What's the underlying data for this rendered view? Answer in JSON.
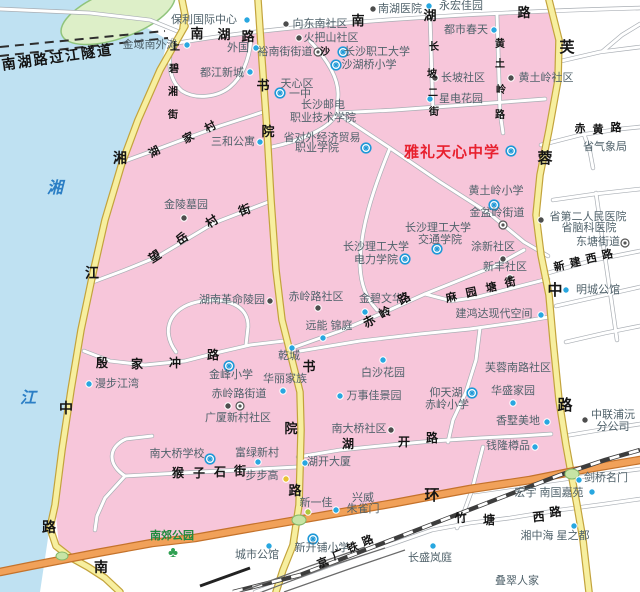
{
  "colors": {
    "water": "#bfe1f2",
    "urban_pink": "#f7c6da",
    "island_fill": "#ddefc8",
    "island_stroke": "#90c47c",
    "yellow_road": "#f7ef9f",
    "orange_ring": "#f1a159",
    "white_road": "#ffffff",
    "dot_blue": "#28a7e0",
    "dot_dark": "#4d4d4d",
    "dot_yellow": "#e8c133",
    "dot_ygreen": "#afc83c",
    "school_blue": "#1e98d7",
    "subdistrict_gray": "#555555",
    "park_green": "#2fa052",
    "poi_text": "#50626b",
    "highlight_red": "#e8202e",
    "river_text": "#2b7ec5",
    "green_blob": "#c7e4a5"
  },
  "icons": {
    "park_glyph": "♣"
  },
  "poi_labels": [
    {
      "t": "保利国际中心",
      "x": 204,
      "y": 23
    },
    {
      "t": "南湖医院",
      "x": 400,
      "y": 12
    },
    {
      "t": "永宏佳园",
      "x": 461,
      "y": 9
    },
    {
      "t": "向东南社区",
      "x": 320,
      "y": 27
    },
    {
      "t": "金域南外滩",
      "x": 150,
      "y": 48
    },
    {
      "t": "外国",
      "x": 238,
      "y": 51
    },
    {
      "t": "火把山社区",
      "x": 331,
      "y": 41
    },
    {
      "t": "裕南街街道",
      "x": 285,
      "y": 55
    },
    {
      "t": "都江新城",
      "x": 222,
      "y": 76
    },
    {
      "t": "都市春天",
      "x": 466,
      "y": 33
    },
    {
      "t": "长坡社区",
      "x": 463,
      "y": 81
    },
    {
      "t": "星电花园",
      "x": 461,
      "y": 102
    },
    {
      "t": "黄土岭社区",
      "x": 546,
      "y": 81
    },
    {
      "t": "三和公寓",
      "x": 233,
      "y": 145
    },
    {
      "t": "天心区",
      "x": 297,
      "y": 87
    },
    {
      "t": "一中",
      "x": 300,
      "y": 97
    },
    {
      "t": "长沙邮电",
      "x": 323,
      "y": 108
    },
    {
      "t": "职业技术学院",
      "x": 323,
      "y": 121
    },
    {
      "t": "省对外经济贸易",
      "x": 322,
      "y": 141
    },
    {
      "t": "职业学院",
      "x": 317,
      "y": 151
    },
    {
      "t": "沙湖桥小学",
      "x": 369,
      "y": 68
    },
    {
      "t": "长沙职工大学",
      "x": 377,
      "y": 55
    },
    {
      "t": "雅礼天心中学",
      "x": 452,
      "y": 157,
      "cls": "red"
    },
    {
      "t": "黄土岭小学",
      "x": 496,
      "y": 194
    },
    {
      "t": "金盆岭街道",
      "x": 497,
      "y": 216
    },
    {
      "t": "长沙理工大学",
      "x": 438,
      "y": 231
    },
    {
      "t": "交通学院",
      "x": 440,
      "y": 243
    },
    {
      "t": "长沙理工大学",
      "x": 376,
      "y": 250
    },
    {
      "t": "电力学院",
      "x": 376,
      "y": 263
    },
    {
      "t": "涂新社区",
      "x": 493,
      "y": 250
    },
    {
      "t": "新丰社区",
      "x": 505,
      "y": 270
    },
    {
      "t": "省第二人民医院",
      "x": 588,
      "y": 220
    },
    {
      "t": "省脑科医院",
      "x": 589,
      "y": 231
    },
    {
      "t": "东塘街道",
      "x": 598,
      "y": 245
    },
    {
      "t": "明城公馆",
      "x": 598,
      "y": 293
    },
    {
      "t": "省气象局",
      "x": 605,
      "y": 150
    },
    {
      "t": "金陵墓园",
      "x": 186,
      "y": 208
    },
    {
      "t": "湖南革命陵园",
      "x": 232,
      "y": 303
    },
    {
      "t": "赤岭路社区",
      "x": 316,
      "y": 300
    },
    {
      "t": "金碧文华",
      "x": 381,
      "y": 302
    },
    {
      "t": "远能 锦庭",
      "x": 329,
      "y": 329
    },
    {
      "t": "乾城",
      "x": 289,
      "y": 359
    },
    {
      "t": "漫步江湾",
      "x": 117,
      "y": 387
    },
    {
      "t": "金峰小学",
      "x": 231,
      "y": 378
    },
    {
      "t": "华丽家族",
      "x": 285,
      "y": 382
    },
    {
      "t": "赤岭路街道",
      "x": 239,
      "y": 397
    },
    {
      "t": "广厦新村社区",
      "x": 238,
      "y": 421
    },
    {
      "t": "白沙花园",
      "x": 383,
      "y": 376
    },
    {
      "t": "万事佳景园",
      "x": 374,
      "y": 399
    },
    {
      "t": "仰天湖",
      "x": 446,
      "y": 396
    },
    {
      "t": "赤岭小学",
      "x": 447,
      "y": 408
    },
    {
      "t": "华盛家园",
      "x": 513,
      "y": 394
    },
    {
      "t": "芙蓉南路社区",
      "x": 518,
      "y": 371
    },
    {
      "t": "香墅美地",
      "x": 518,
      "y": 424
    },
    {
      "t": "建鸿达现代空间",
      "x": 494,
      "y": 317
    },
    {
      "t": "南大桥社区",
      "x": 359,
      "y": 432
    },
    {
      "t": "南大桥学校",
      "x": 177,
      "y": 457
    },
    {
      "t": "富绿新村",
      "x": 257,
      "y": 456
    },
    {
      "t": "湖开大厦",
      "x": 329,
      "y": 465
    },
    {
      "t": "步步高",
      "x": 262,
      "y": 479
    },
    {
      "t": "钱隆樽品",
      "x": 508,
      "y": 449
    },
    {
      "t": "兴威",
      "x": 363,
      "y": 501
    },
    {
      "t": "朱雀门",
      "x": 363,
      "y": 512
    },
    {
      "t": "新一佳",
      "x": 316,
      "y": 506
    },
    {
      "t": "城市公馆",
      "x": 257,
      "y": 558
    },
    {
      "t": "新开铺小学",
      "x": 322,
      "y": 551
    },
    {
      "t": "长盛岚庭",
      "x": 430,
      "y": 561
    },
    {
      "t": "湘中海 星之都",
      "x": 555,
      "y": 539
    },
    {
      "t": "宏宇 南国嘉苑",
      "x": 549,
      "y": 496
    },
    {
      "t": "剑桥名门",
      "x": 606,
      "y": 481
    },
    {
      "t": "叠翠人家",
      "x": 517,
      "y": 584
    },
    {
      "t": "中联浦沅",
      "x": 613,
      "y": 418
    },
    {
      "t": "分公司",
      "x": 613,
      "y": 430
    },
    {
      "t": "南郊公园",
      "x": 172,
      "y": 539,
      "cls": "green"
    },
    {
      "t": "湘",
      "x": 55,
      "y": 193,
      "cls": "river"
    },
    {
      "t": "江",
      "x": 28,
      "y": 403,
      "cls": "river"
    }
  ],
  "road_chars": [
    {
      "t": "南湖路过江隧道",
      "x": 58,
      "y": 62,
      "s": 14,
      "r": -8,
      "ls": 2
    },
    {
      "t": "南",
      "x": 197,
      "y": 38,
      "s": 13
    },
    {
      "t": "湖",
      "x": 224,
      "y": 39,
      "s": 13
    },
    {
      "t": "路",
      "x": 248,
      "y": 41,
      "s": 13
    },
    {
      "t": "南",
      "x": 358,
      "y": 25,
      "s": 13
    },
    {
      "t": "湖",
      "x": 430,
      "y": 20,
      "s": 13
    },
    {
      "t": "路",
      "x": 524,
      "y": 17,
      "s": 13
    },
    {
      "t": "书",
      "x": 263,
      "y": 90,
      "s": 13
    },
    {
      "t": "院",
      "x": 268,
      "y": 136,
      "s": 13
    },
    {
      "t": "书",
      "x": 309,
      "y": 371,
      "s": 13
    },
    {
      "t": "院",
      "x": 291,
      "y": 433,
      "s": 13
    },
    {
      "t": "路",
      "x": 295,
      "y": 495,
      "s": 13
    },
    {
      "t": "湘",
      "x": 120,
      "y": 163,
      "s": 14
    },
    {
      "t": "江",
      "x": 92,
      "y": 278,
      "s": 14
    },
    {
      "t": "中",
      "x": 66,
      "y": 413,
      "s": 14
    },
    {
      "t": "路",
      "x": 49,
      "y": 532,
      "s": 14
    },
    {
      "t": "南",
      "x": 101,
      "y": 572,
      "s": 14
    },
    {
      "t": "芙",
      "x": 567,
      "y": 52,
      "s": 15
    },
    {
      "t": "蓉",
      "x": 545,
      "y": 163,
      "s": 15
    },
    {
      "t": "中",
      "x": 555,
      "y": 295,
      "s": 15
    },
    {
      "t": "路",
      "x": 565,
      "y": 410,
      "s": 15
    },
    {
      "t": "环",
      "x": 432,
      "y": 500,
      "s": 15
    },
    {
      "t": "猴",
      "x": 178,
      "y": 477,
      "s": 12
    },
    {
      "t": "子",
      "x": 199,
      "y": 477,
      "s": 12
    },
    {
      "t": "石",
      "x": 220,
      "y": 476,
      "s": 12
    },
    {
      "t": "街",
      "x": 240,
      "y": 475,
      "s": 12
    },
    {
      "t": "殷",
      "x": 102,
      "y": 367,
      "s": 12
    },
    {
      "t": "家",
      "x": 137,
      "y": 368,
      "s": 12
    },
    {
      "t": "冲",
      "x": 175,
      "y": 367,
      "s": 12
    },
    {
      "t": "路",
      "x": 213,
      "y": 359,
      "s": 12
    },
    {
      "t": "望",
      "x": 157,
      "y": 260,
      "s": 12,
      "r": -33
    },
    {
      "t": "岳",
      "x": 184,
      "y": 242,
      "s": 12,
      "r": -33
    },
    {
      "t": "村",
      "x": 214,
      "y": 225,
      "s": 12,
      "r": -33
    },
    {
      "t": "街",
      "x": 246,
      "y": 214,
      "s": 12,
      "r": -20
    },
    {
      "t": "湖",
      "x": 156,
      "y": 155,
      "s": 11,
      "r": -28
    },
    {
      "t": "家",
      "x": 190,
      "y": 141,
      "s": 11,
      "r": -28
    },
    {
      "t": "村",
      "x": 212,
      "y": 130,
      "s": 11,
      "r": -28
    },
    {
      "t": "上",
      "x": 175,
      "y": 50,
      "s": 10
    },
    {
      "t": "碧",
      "x": 174,
      "y": 72,
      "s": 10
    },
    {
      "t": "湘",
      "x": 173,
      "y": 95,
      "s": 10
    },
    {
      "t": "街",
      "x": 173,
      "y": 118,
      "s": 10
    },
    {
      "t": "长",
      "x": 434,
      "y": 50,
      "s": 10
    },
    {
      "t": "坡",
      "x": 432,
      "y": 77,
      "s": 10
    },
    {
      "t": "二",
      "x": 433,
      "y": 96,
      "s": 10
    },
    {
      "t": "街",
      "x": 434,
      "y": 115,
      "s": 10
    },
    {
      "t": "黄",
      "x": 500,
      "y": 47,
      "s": 10
    },
    {
      "t": "土",
      "x": 500,
      "y": 67,
      "s": 10
    },
    {
      "t": "岭",
      "x": 501,
      "y": 93,
      "s": 10
    },
    {
      "t": "路",
      "x": 500,
      "y": 118,
      "s": 10
    },
    {
      "t": "沙",
      "x": 325,
      "y": 55,
      "s": 10
    },
    {
      "t": "赤",
      "x": 371,
      "y": 325,
      "s": 12,
      "r": -28
    },
    {
      "t": "岭",
      "x": 387,
      "y": 316,
      "s": 12,
      "r": -28
    },
    {
      "t": "路",
      "x": 406,
      "y": 302,
      "s": 12,
      "r": -28
    },
    {
      "t": "麻",
      "x": 452,
      "y": 301,
      "s": 11,
      "r": -12
    },
    {
      "t": "园",
      "x": 472,
      "y": 296,
      "s": 11,
      "r": -12
    },
    {
      "t": "塘",
      "x": 492,
      "y": 291,
      "s": 11,
      "r": -12
    },
    {
      "t": "街",
      "x": 511,
      "y": 286,
      "s": 11,
      "r": -12
    },
    {
      "t": "湖",
      "x": 348,
      "y": 448,
      "s": 12
    },
    {
      "t": "开",
      "x": 404,
      "y": 446,
      "s": 12
    },
    {
      "t": "路",
      "x": 432,
      "y": 442,
      "s": 12
    },
    {
      "t": "新",
      "x": 560,
      "y": 270,
      "s": 11,
      "r": -12
    },
    {
      "t": "建",
      "x": 576,
      "y": 266,
      "s": 11,
      "r": -12
    },
    {
      "t": "西",
      "x": 592,
      "y": 262,
      "s": 11,
      "r": -12
    },
    {
      "t": "路",
      "x": 608,
      "y": 258,
      "s": 11,
      "r": -12
    },
    {
      "t": "赤",
      "x": 580,
      "y": 132,
      "s": 11
    },
    {
      "t": "黄",
      "x": 598,
      "y": 133,
      "s": 11
    },
    {
      "t": "路",
      "x": 616,
      "y": 131,
      "s": 11
    },
    {
      "t": "竹",
      "x": 461,
      "y": 522,
      "s": 12,
      "r": -3
    },
    {
      "t": "塘",
      "x": 489,
      "y": 524,
      "s": 12
    },
    {
      "t": "西",
      "x": 539,
      "y": 521,
      "s": 12,
      "r": -5
    },
    {
      "t": "路",
      "x": 556,
      "y": 516,
      "s": 12,
      "r": -8
    },
    {
      "t": "京",
      "x": 324,
      "y": 566,
      "s": 11,
      "r": -22
    },
    {
      "t": "广",
      "x": 339,
      "y": 558,
      "s": 11,
      "r": -22
    },
    {
      "t": "铁",
      "x": 354,
      "y": 551,
      "s": 11,
      "r": -22
    },
    {
      "t": "路",
      "x": 369,
      "y": 544,
      "s": 11,
      "r": -22
    }
  ],
  "markers": [
    {
      "k": "blue",
      "x": 247,
      "y": 20
    },
    {
      "k": "blue",
      "x": 429,
      "y": 6
    },
    {
      "k": "blue",
      "x": 187,
      "y": 45
    },
    {
      "k": "blue",
      "x": 256,
      "y": 48
    },
    {
      "k": "blue",
      "x": 250,
      "y": 72
    },
    {
      "k": "blue",
      "x": 494,
      "y": 30
    },
    {
      "k": "blue",
      "x": 430,
      "y": 99
    },
    {
      "k": "blue",
      "x": 260,
      "y": 142
    },
    {
      "k": "blue",
      "x": 365,
      "y": 312
    },
    {
      "k": "blue",
      "x": 323,
      "y": 338
    },
    {
      "k": "blue",
      "x": 292,
      "y": 348
    },
    {
      "k": "blue",
      "x": 89,
      "y": 384
    },
    {
      "k": "blue",
      "x": 283,
      "y": 391
    },
    {
      "k": "blue",
      "x": 383,
      "y": 360
    },
    {
      "k": "blue",
      "x": 340,
      "y": 396
    },
    {
      "k": "blue",
      "x": 541,
      "y": 315
    },
    {
      "k": "blue",
      "x": 513,
      "y": 403
    },
    {
      "k": "blue",
      "x": 547,
      "y": 422
    },
    {
      "k": "blue",
      "x": 305,
      "y": 463
    },
    {
      "k": "blue",
      "x": 258,
      "y": 462
    },
    {
      "k": "blue",
      "x": 535,
      "y": 447
    },
    {
      "k": "blue",
      "x": 336,
      "y": 510
    },
    {
      "k": "blue",
      "x": 269,
      "y": 546
    },
    {
      "k": "blue",
      "x": 433,
      "y": 546
    },
    {
      "k": "blue",
      "x": 574,
      "y": 526
    },
    {
      "k": "blue",
      "x": 592,
      "y": 492
    },
    {
      "k": "blue",
      "x": 579,
      "y": 480
    },
    {
      "k": "blue",
      "x": 566,
      "y": 290
    },
    {
      "k": "dark",
      "x": 373,
      "y": 9
    },
    {
      "k": "dark",
      "x": 286,
      "y": 24
    },
    {
      "k": "dark",
      "x": 299,
      "y": 38
    },
    {
      "k": "dark",
      "x": 435,
      "y": 78
    },
    {
      "k": "dark",
      "x": 511,
      "y": 78
    },
    {
      "k": "dark",
      "x": 541,
      "y": 220
    },
    {
      "k": "dark",
      "x": 503,
      "y": 259
    },
    {
      "k": "dark",
      "x": 510,
      "y": 278
    },
    {
      "k": "dark",
      "x": 270,
      "y": 301
    },
    {
      "k": "dark",
      "x": 318,
      "y": 308
    },
    {
      "k": "dark",
      "x": 184,
      "y": 218
    },
    {
      "k": "dark",
      "x": 391,
      "y": 430
    },
    {
      "k": "dark",
      "x": 585,
      "y": 420
    },
    {
      "k": "dark",
      "x": 228,
      "y": 406
    },
    {
      "k": "yellow",
      "x": 286,
      "y": 479
    },
    {
      "k": "ygreen",
      "x": 308,
      "y": 512
    },
    {
      "k": "school",
      "x": 280,
      "y": 93
    },
    {
      "k": "school",
      "x": 366,
      "y": 148
    },
    {
      "k": "school",
      "x": 336,
      "y": 65
    },
    {
      "k": "school",
      "x": 343,
      "y": 52
    },
    {
      "k": "school",
      "x": 511,
      "y": 151
    },
    {
      "k": "school",
      "x": 494,
      "y": 205
    },
    {
      "k": "school",
      "x": 437,
      "y": 249
    },
    {
      "k": "school",
      "x": 405,
      "y": 259
    },
    {
      "k": "school",
      "x": 229,
      "y": 366
    },
    {
      "k": "school",
      "x": 472,
      "y": 393
    },
    {
      "k": "school",
      "x": 210,
      "y": 459
    },
    {
      "k": "school",
      "x": 313,
      "y": 539
    },
    {
      "k": "subdistrict",
      "x": 318,
      "y": 52
    },
    {
      "k": "subdistrict",
      "x": 503,
      "y": 225
    },
    {
      "k": "subdistrict",
      "x": 240,
      "y": 406
    },
    {
      "k": "subdistrict",
      "x": 625,
      "y": 243
    },
    {
      "k": "park",
      "x": 173,
      "y": 552
    }
  ]
}
